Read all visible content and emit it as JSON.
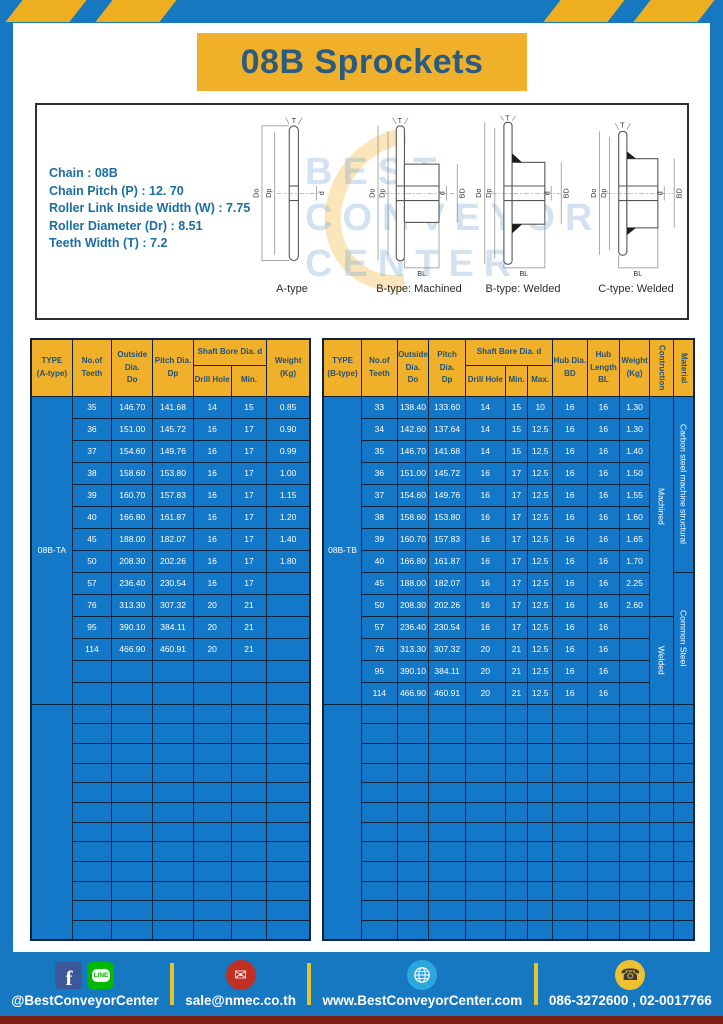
{
  "title": "08B Sprockets",
  "specs": [
    "Chain  : 08B",
    "Chain Pitch (P)  :  12. 70",
    "Roller Link Inside Width (W)  :  7.75",
    "Roller Diameter (Dr)  : 8.51",
    "Teeth Width (T)  :  7.2"
  ],
  "diagram": {
    "labels": [
      "A-type",
      "B-type: Machined",
      "B-type: Welded",
      "C-type: Welded"
    ],
    "dims": {
      "t": "T",
      "do": "Do",
      "dp": "Dp",
      "d": "d",
      "bd": "BD",
      "bl": "BL"
    },
    "watermark": [
      "BEST",
      "CONVEYOR",
      "CENTER"
    ]
  },
  "tableA": {
    "type_label": "08B-TA",
    "col_widths": [
      14.8,
      14.1,
      14.8,
      14.4,
      13.7,
      12.7,
      15.5
    ],
    "header": {
      "plain": [
        [
          "TYPE",
          "(A-type)"
        ],
        [
          "No.of",
          "Teeth"
        ],
        [
          "Outside",
          "Dia.",
          "Do"
        ],
        [
          "Pitch Dia.",
          "Dp"
        ]
      ],
      "group": {
        "label": "Shaft Bore Dia. d",
        "children": [
          [
            "Drill Hole"
          ],
          [
            "Min."
          ]
        ]
      },
      "tail": [
        [
          "Weight",
          "(Kg)"
        ]
      ],
      "vertical": []
    },
    "rows": [
      [
        "35",
        "146.70",
        "141.68",
        "14",
        "15",
        "0.85"
      ],
      [
        "36",
        "151.00",
        "145.72",
        "16",
        "17",
        "0.90"
      ],
      [
        "37",
        "154.60",
        "149.76",
        "16",
        "17",
        "0.99"
      ],
      [
        "38",
        "158.60",
        "153.80",
        "16",
        "17",
        "1.00"
      ],
      [
        "39",
        "160.70",
        "157.83",
        "16",
        "17",
        "1.15"
      ],
      [
        "40",
        "166.80",
        "161.87",
        "16",
        "17",
        "1.20"
      ],
      [
        "45",
        "188.00",
        "182.07",
        "16",
        "17",
        "1.40"
      ],
      [
        "50",
        "208.30",
        "202.26",
        "16",
        "17",
        "1.80"
      ],
      [
        "57",
        "236.40",
        "230.54",
        "16",
        "17",
        ""
      ],
      [
        "76",
        "313.30",
        "307.32",
        "20",
        "21",
        ""
      ],
      [
        "95",
        "390.10",
        "384.11",
        "20",
        "21",
        ""
      ],
      [
        "114",
        "466.90",
        "460.91",
        "20",
        "21",
        ""
      ]
    ],
    "section1_rows": 14,
    "section2_rows": 12
  },
  "tableB": {
    "type_label": "08B-TB",
    "col_widths": [
      10.4,
      9.6,
      8.5,
      9.9,
      10.7,
      6.1,
      6.7,
      9.3,
      8.8,
      8.0,
      6.4,
      5.6
    ],
    "header": {
      "plain": [
        [
          "TYPE",
          "(B-type)"
        ],
        [
          "No.of",
          "Teeth"
        ],
        [
          "Outside",
          "Dia.",
          "Do"
        ],
        [
          "Pitch Dia.",
          "Dp"
        ]
      ],
      "group": {
        "label": "Shaft Bore Dia. d",
        "children": [
          [
            "Drill Hole"
          ],
          [
            "Min."
          ],
          [
            "Max."
          ]
        ]
      },
      "tail": [
        [
          "Hub Dia.",
          "BD"
        ],
        [
          "Hub",
          "Length",
          "BL"
        ],
        [
          "Weight",
          "(Kg)"
        ]
      ],
      "vertical": [
        "Contruction",
        "Material"
      ]
    },
    "rows": [
      [
        "33",
        "138.40",
        "133.60",
        "14",
        "15",
        "10",
        "16",
        "16",
        "1.30"
      ],
      [
        "34",
        "142.60",
        "137.64",
        "14",
        "15",
        "12.5",
        "16",
        "16",
        "1.30"
      ],
      [
        "35",
        "146.70",
        "141.68",
        "14",
        "15",
        "12.5",
        "16",
        "16",
        "1.40"
      ],
      [
        "36",
        "151.00",
        "145.72",
        "16",
        "17",
        "12.5",
        "16",
        "16",
        "1.50"
      ],
      [
        "37",
        "154.60",
        "149.76",
        "16",
        "17",
        "12.5",
        "16",
        "16",
        "1.55"
      ],
      [
        "38",
        "158.60",
        "153.80",
        "16",
        "17",
        "12.5",
        "16",
        "16",
        "1.60"
      ],
      [
        "39",
        "160.70",
        "157.83",
        "16",
        "17",
        "12.5",
        "16",
        "16",
        "1.65"
      ],
      [
        "40",
        "166.80",
        "161.87",
        "16",
        "17",
        "12.5",
        "16",
        "16",
        "1.70"
      ],
      [
        "45",
        "188.00",
        "182.07",
        "16",
        "17",
        "12.5",
        "16",
        "16",
        "2.25"
      ],
      [
        "50",
        "208.30",
        "202.26",
        "16",
        "17",
        "12.5",
        "16",
        "16",
        "2.60"
      ],
      [
        "57",
        "236.40",
        "230.54",
        "16",
        "17",
        "12.5",
        "16",
        "16",
        ""
      ],
      [
        "76",
        "313.30",
        "307.32",
        "20",
        "21",
        "12.5",
        "16",
        "16",
        ""
      ],
      [
        "95",
        "390.10",
        "384.11",
        "20",
        "21",
        "12.5",
        "16",
        "16",
        ""
      ],
      [
        "114",
        "466.90",
        "460.91",
        "20",
        "21",
        "12.5",
        "16",
        "16",
        ""
      ]
    ],
    "construction": [
      {
        "label": "Machined",
        "rows": 10
      },
      {
        "label": "Welded",
        "rows": 4
      }
    ],
    "material": [
      {
        "label": "Carbon steel  machine structural",
        "rows": 8
      },
      {
        "label": "Common  Steel",
        "rows": 6
      }
    ],
    "section1_rows": 14,
    "section2_rows": 12
  },
  "footer": {
    "facebook": "@BestConveyorCenter",
    "email": "sale@nmec.co.th",
    "website": "www.BestConveyorCenter.com",
    "phone": "086-3272600 , 02-0017766",
    "line_label": "LINE",
    "fb_letter": "f",
    "mail_glyph": "✉",
    "phone_glyph": "☎"
  },
  "colors": {
    "frame_blue": "#1778C2",
    "cell_blue": "#1478C9",
    "accent_yellow": "#F0B02A",
    "grid_navy": "#0C2440",
    "title_text": "#2A5B80",
    "bottom_maroon": "#7E1D14"
  }
}
